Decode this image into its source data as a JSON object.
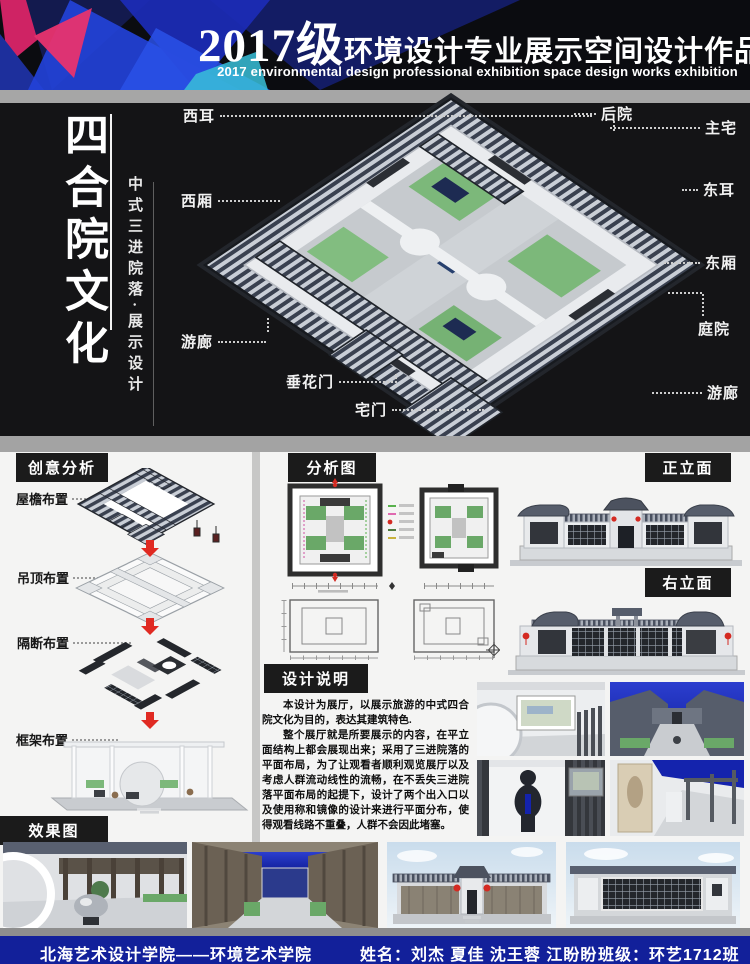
{
  "header": {
    "year": "2017级",
    "title_cn": "环境设计专业展示空间设计作品展",
    "subtitle_en": "2017 environmental design professional exhibition space design works exhibition"
  },
  "side_title": {
    "main": "四合院文化",
    "sub": "中式三进院落·展示设计"
  },
  "model_labels": {
    "items": [
      {
        "text": "西耳"
      },
      {
        "text": "西厢"
      },
      {
        "text": "游廊"
      },
      {
        "text": "垂花门"
      },
      {
        "text": "宅门"
      },
      {
        "text": "后院"
      },
      {
        "text": "主宅"
      },
      {
        "text": "东耳"
      },
      {
        "text": "东厢"
      },
      {
        "text": "庭院"
      },
      {
        "text": "游廊"
      }
    ]
  },
  "sections": {
    "creative_analysis": "创意分析",
    "analysis_diagram": "分析图",
    "front_elevation": "正立面",
    "right_elevation": "右立面",
    "design_notes": "设计说明",
    "effect_render": "效果图"
  },
  "creative_steps": {
    "items": [
      {
        "label": "屋檐布置"
      },
      {
        "label": "吊顶布置"
      },
      {
        "label": "隔断布置"
      },
      {
        "label": "框架布置"
      }
    ]
  },
  "design_notes": {
    "p1": "本设计为展厅，以展示旅游的中式四合院文化为目的，表达其建筑特色.",
    "p2": "整个展厅就是所要展示的内容，在平立面结构上都会展现出来；采用了三进院落的平面布局，为了让观看者顺利观览展厅以及考虑人群流动线性的流畅，在不丢失三进院落平面布局的起提下，设计了两个出入口以及使用称和镜像的设计来进行平面分布，使得观看线路不重叠，人群不会因此堵塞。"
  },
  "footer": {
    "school": "北海艺术设计学院——环境艺术学院",
    "names": "姓名：刘杰 夏佳 沈王蓉 江盼盼",
    "class_label": "班级：环艺1712班"
  },
  "colors": {
    "accent_red": "#d42a22",
    "footer_blue": "#12209a",
    "night_blue": "#1423ad",
    "roof_dark": "#3a4150",
    "lawn_green": "#7cb87a",
    "header_pink": "#e8336e",
    "header_blue": "#2342d8"
  }
}
